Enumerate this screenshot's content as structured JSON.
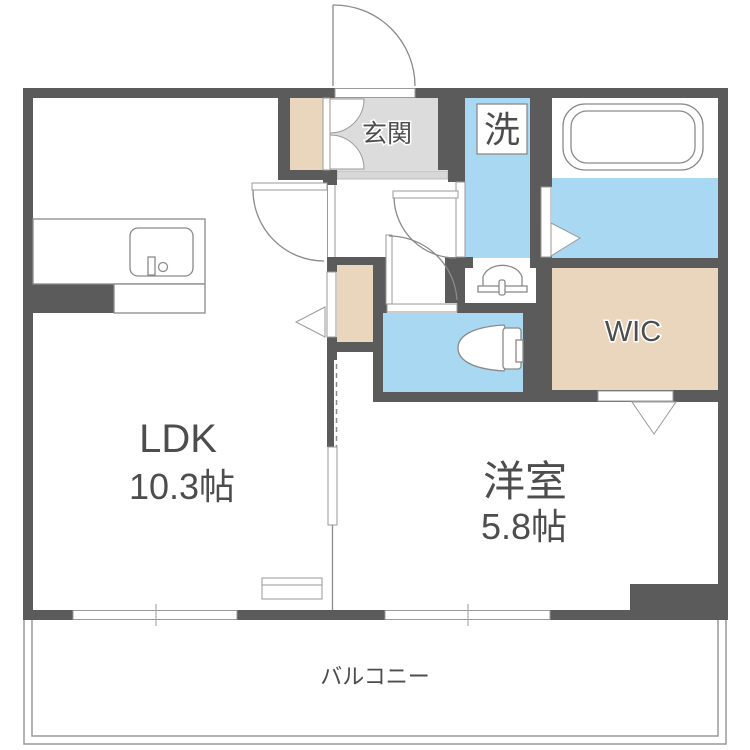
{
  "floorplan": {
    "labels": {
      "ldk_name": "LDK",
      "ldk_size": "10.3帖",
      "bedroom_name": "洋室",
      "bedroom_size": "5.8帖",
      "entrance": "玄関",
      "laundry": "洗",
      "wic": "WIC",
      "balcony": "バルコニー"
    },
    "colors": {
      "wall": "#5b5b5b",
      "wet_floor": "#a9d9f2",
      "storage_floor": "#e9d6bd",
      "entrance_floor": "#dcdcdc",
      "step": "#d8d8d8",
      "outline": "#8a8a8a",
      "label_text": "#4d4d4d"
    }
  }
}
